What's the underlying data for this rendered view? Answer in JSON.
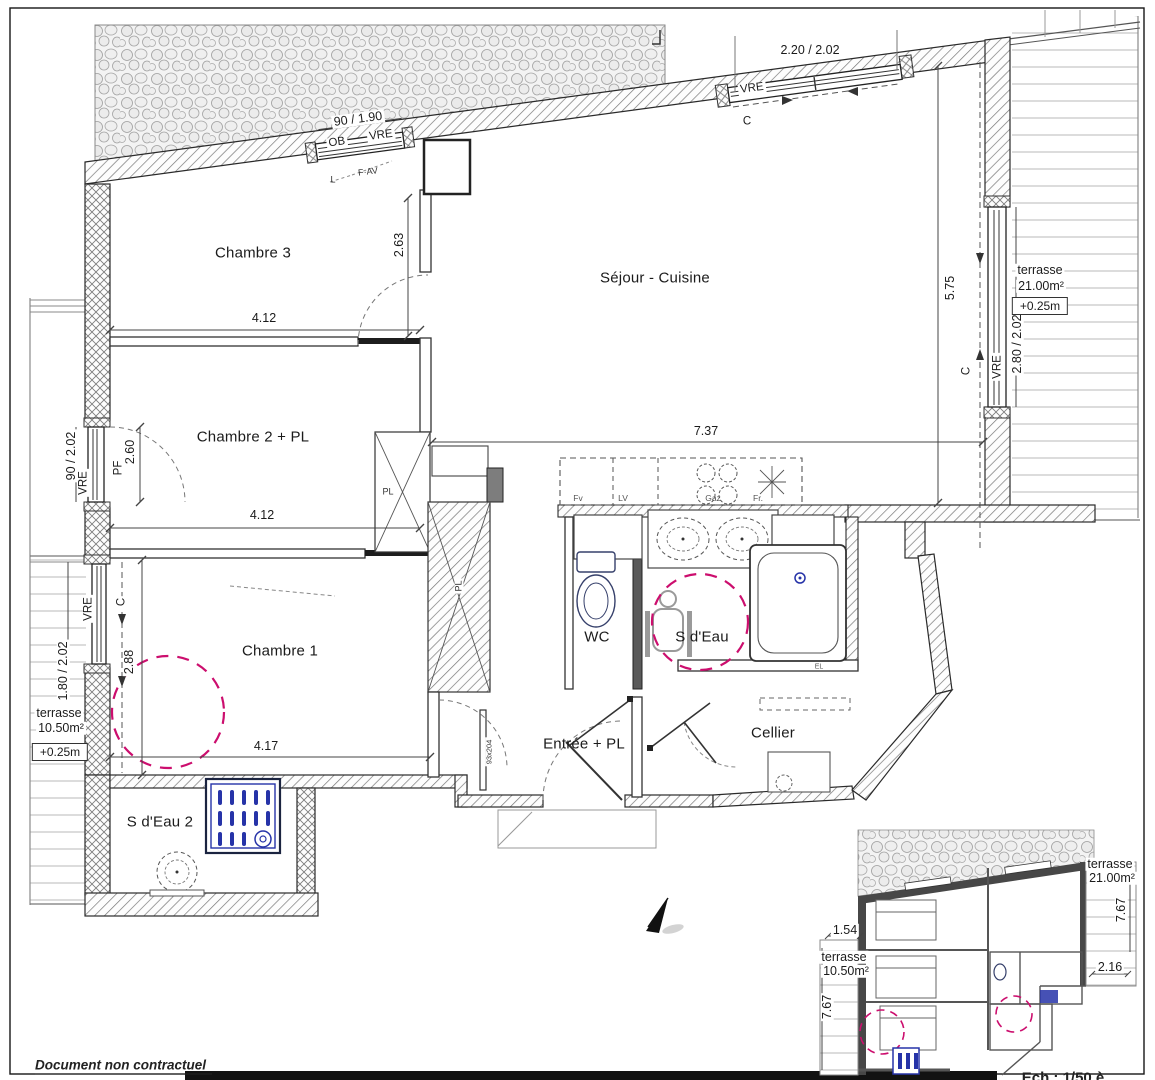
{
  "footer": {
    "disclaimer": "Document non contractuel",
    "scale": "Ech : 1/50 è"
  },
  "rooms": {
    "chambre3": "Chambre 3",
    "sejour_cuisine": "Séjour - Cuisine",
    "chambre2": "Chambre 2 + PL",
    "chambre1": "Chambre 1",
    "wc": "WC",
    "salle_eau": "S d'Eau",
    "entree": "Entrée + PL",
    "cellier": "Cellier",
    "salle_eau2": "S d'Eau 2",
    "placard1": "PL",
    "placard2": "PL"
  },
  "dims": {
    "chambre3_width": "4.12",
    "chambre3_depth": "2.63",
    "sejour_width": "7.37",
    "sejour_depth": "5.75",
    "chambre2_width": "4.12",
    "chambre2_door": "2.60",
    "chambre1_width": "4.17",
    "chambre1_depth": "2.88",
    "entry_door_size": "93x204"
  },
  "openings": {
    "bay_window": {
      "dim": "2.20 / 2.02",
      "type": "VRE",
      "track": "C"
    },
    "ob_window": {
      "dim": "90 / 1.90",
      "tag_ob": "OB",
      "type": "VRE",
      "tag_fav": "F·AV",
      "tag_l": "L"
    },
    "right_window": {
      "dim": "2.80 / 2.02",
      "type": "VRE",
      "track": "C"
    },
    "pf_window": {
      "dim": "90 / 2.02",
      "type": "VRE",
      "tag_pf": "PF"
    },
    "chambre1_window": {
      "dim": "1.80 / 2.02",
      "type": "VRE",
      "track": "C"
    }
  },
  "terraces": {
    "right": {
      "name": "terrasse",
      "area": "21.00m²",
      "level": "+0.25m"
    },
    "left": {
      "name": "terrasse",
      "area": "10.50m²",
      "level": "+0.25m"
    }
  },
  "kitchen": {
    "oven": "Fv",
    "dishwasher": "LV",
    "hob": "Gaz",
    "fridge": "Fr."
  },
  "labels": {
    "el": "EL"
  },
  "inset": {
    "terrace_right": {
      "name": "terrasse",
      "area": "21.00m²",
      "depth": "7.67",
      "width": "2.16"
    },
    "terrace_left": {
      "width": "1.54",
      "name": "terrasse",
      "area": "10.50m²",
      "depth": "7.67"
    }
  }
}
